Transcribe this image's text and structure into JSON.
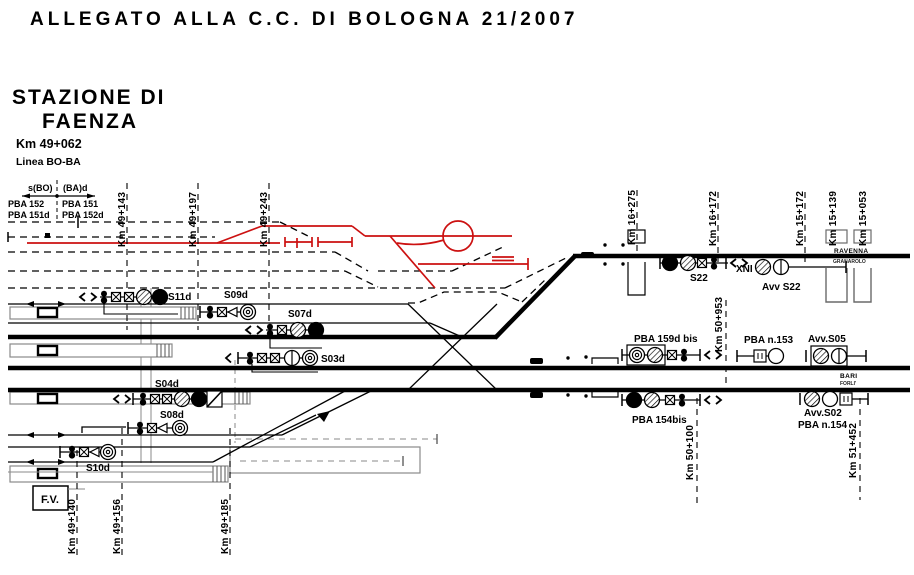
{
  "header": {
    "title": "ALLEGATO ALLA C.C. DI BOLOGNA 21/2007"
  },
  "station": {
    "title_line1": "STAZIONE DI",
    "title_line2": "FAENZA",
    "km": "Km 49+062",
    "line": "Linea BO-BA"
  },
  "pba_block": {
    "dir_left": "s(BO)",
    "dir_right": "(BA)d",
    "rows_left": [
      "PBA 152",
      "PBA 151d"
    ],
    "rows_right": [
      "PBA 151",
      "PBA 152d"
    ]
  },
  "km_markers": {
    "top_left": [
      "Km 49+143",
      "Km 49+197",
      "Km 49+243"
    ],
    "bottom_left": [
      "Km 49+140",
      "Km 49+156",
      "Km 49+185"
    ],
    "top_right": [
      "Km 16+275",
      "Km 16+172",
      "Km 15+172",
      "Km 15+139",
      "Km 15+053"
    ],
    "mid_right": [
      "Km 50+953"
    ],
    "bottom_right": [
      "Km 50+100",
      "Km 51+452"
    ]
  },
  "signals": {
    "s11d": "S11d",
    "s09d": "S09d",
    "s07d": "S07d",
    "s03d": "S03d",
    "s04d": "S04d",
    "s08d": "S08d",
    "s10d": "S10d",
    "s22": "S22",
    "xni": "XNI",
    "avv_s22": "Avv S22",
    "pba_159d_bis": "PBA 159d bis",
    "pba_n153": "PBA n.153",
    "avv_s05": "Avv.S05",
    "pba_154bis": "PBA 154bis",
    "avv_s02": "Avv.S02",
    "pba_n154": "PBA n.154"
  },
  "directions": {
    "ravenna": "RAVENNA",
    "ravenna_sub": "GRANAROLO",
    "bari": "BARI",
    "bari_sub": "FORLI'"
  },
  "building": {
    "label": "F.V."
  },
  "colors": {
    "track": "#000000",
    "modified_red": "#cc1111",
    "minor_gray": "#8a8a8a"
  }
}
